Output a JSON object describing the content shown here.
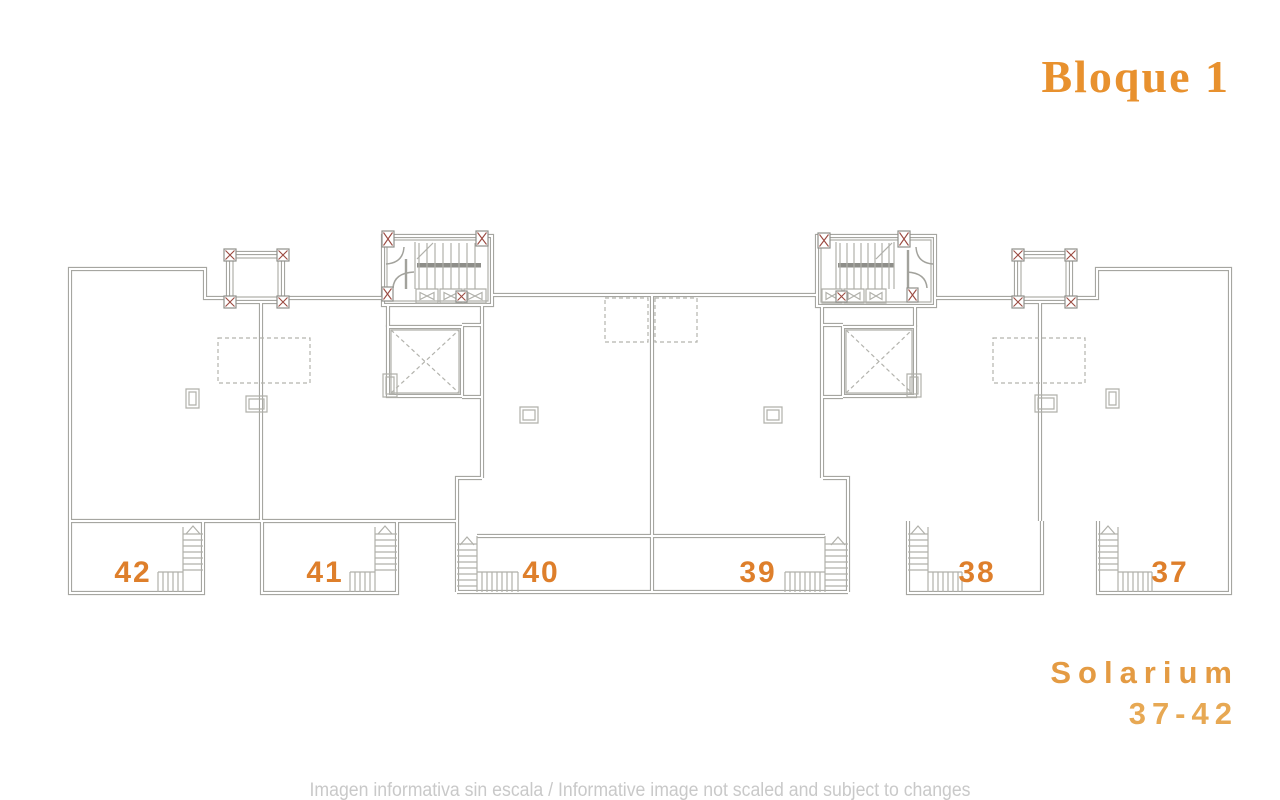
{
  "title": "Bloque 1",
  "units": [
    "42",
    "41",
    "40",
    "39",
    "38",
    "37"
  ],
  "solarium": {
    "line1": "Solarium",
    "line2": "37-42"
  },
  "disclaimer": "Imagen informativa sin escala /  Informative image not scaled and subject to changes",
  "colors": {
    "unit_number_orange": "#de7f2b",
    "title_orange": "#e8912e",
    "solarium_orange": "#e49b43",
    "plan_line_gray": "#a6a6a1",
    "detail_red": "#9b4a41",
    "disclaimer_gray": "#c9c9c9"
  }
}
